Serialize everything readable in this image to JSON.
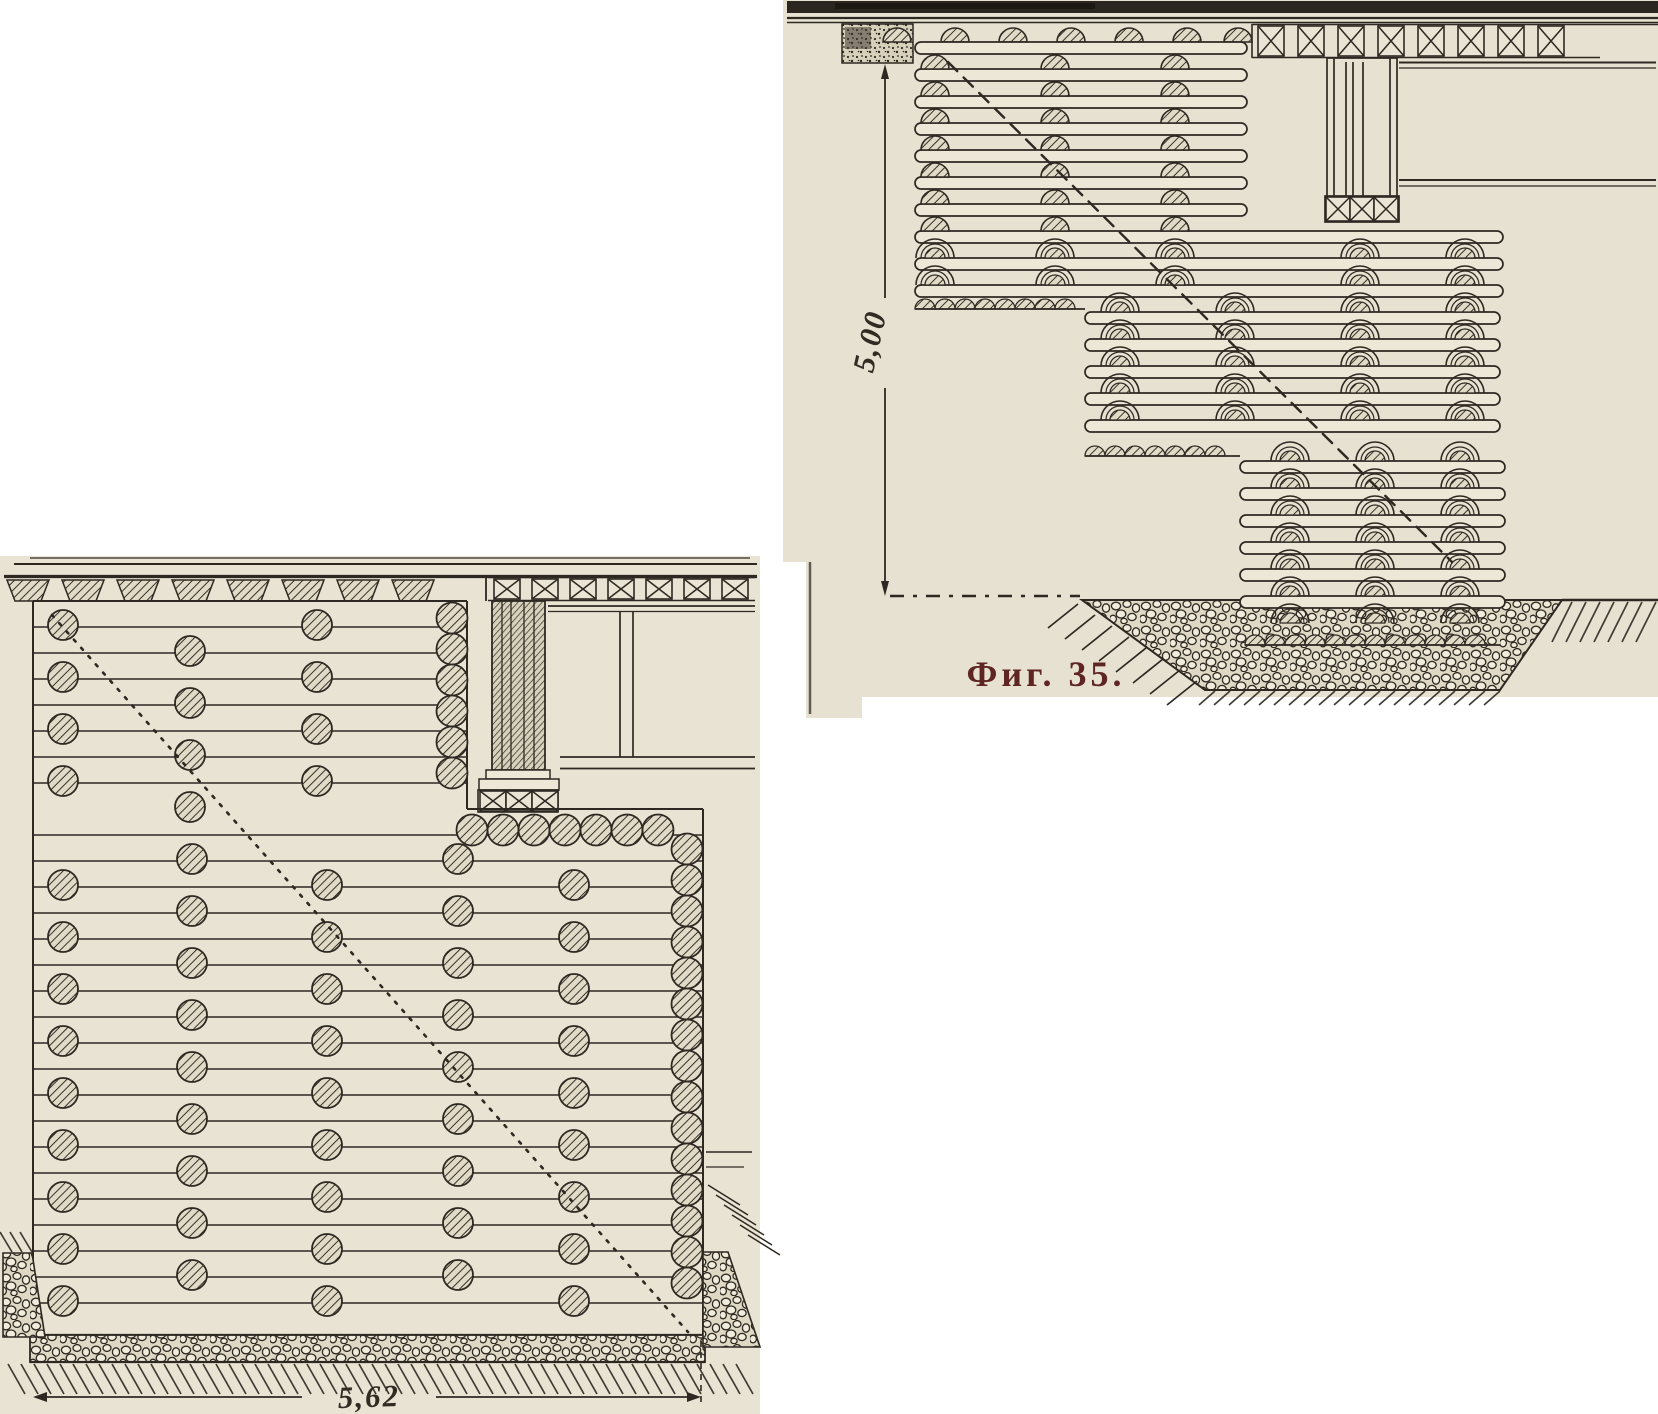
{
  "page": {
    "background": "#ffffff",
    "scan_left_bg": "#e8e3d3",
    "scan_right_bg": "#e6e1d1",
    "ink_color": "#2e2822",
    "caption_color": "#5e2522"
  },
  "figure_35": {
    "caption": "Фиг. 35.",
    "height_dimension": "5,00"
  },
  "front_view_figure": {
    "width_dimension": "5,62"
  }
}
